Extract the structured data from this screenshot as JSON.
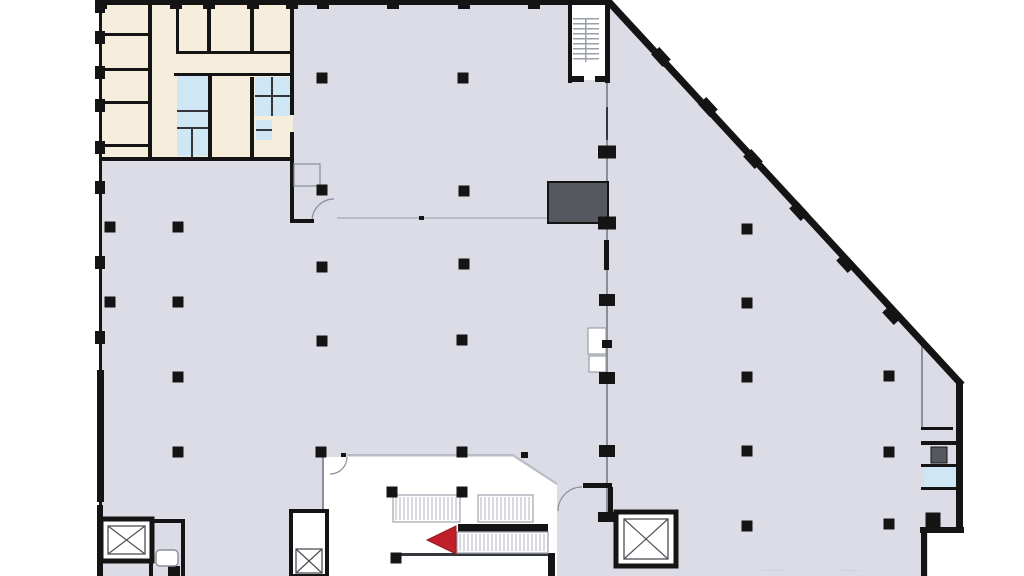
{
  "meta": {
    "type": "architectural-floor-plan",
    "description": "ground floor plan with office block, restrooms, stair, elevators, escalators and angled curtain wall",
    "visible_text_note": "no legible text; two tiny illegible dimension strings at bottom right"
  },
  "colors": {
    "page": "#ffffff",
    "floor": "#dcdce6",
    "room_beige": "#f6eddc",
    "room_blue": "#cfe7f5",
    "shaft_dark": "#55595f",
    "wall": "#141414",
    "wall_soft": "#33363a",
    "line_light": "#b9bcc6",
    "line_mid": "#8a8f98",
    "hatch": "#b5b8c2",
    "band_border": "#a7aab4",
    "tread": "#9aa0a8",
    "xline": "#4c5056",
    "arrow_red": "#c1202b",
    "text_gray": "#8f8f94",
    "void_white": "#ffffff"
  },
  "annotations": [
    {
      "name": "dimension-text-1",
      "x": 762,
      "y": 572,
      "text": "·········"
    },
    {
      "name": "dimension-text-2",
      "x": 837,
      "y": 572,
      "text": "·········"
    }
  ],
  "plan": {
    "canvas": {
      "w": 1024,
      "h": 576
    },
    "floor_points": "99,0 609,0 962,385 962,530 928,530 928,576 99,576",
    "void_points": "323,457 513,457 557,485 557,576 323,576",
    "fills": [
      {
        "n": "office-block",
        "x": 102,
        "y": 0,
        "w": 191,
        "h": 158,
        "f": "room_beige"
      },
      {
        "n": "restroom-left",
        "x": 177,
        "y": 76,
        "w": 31,
        "h": 80,
        "f": "room_blue"
      },
      {
        "n": "restroom-right",
        "x": 255,
        "y": 77,
        "w": 35,
        "h": 39,
        "f": "room_blue"
      },
      {
        "n": "sink-fixture",
        "x": 256,
        "y": 120,
        "w": 16,
        "h": 20,
        "f": "room_blue"
      },
      {
        "n": "right-room-blue",
        "x": 924,
        "y": 467,
        "w": 34,
        "h": 21,
        "f": "room_blue"
      },
      {
        "n": "stair-room",
        "x": 568,
        "y": 2,
        "w": 40,
        "h": 78,
        "f": "void_white"
      }
    ],
    "outlined": [
      {
        "n": "service-shaft",
        "x": 548,
        "y": 182,
        "w": 60,
        "h": 41,
        "f": "shaft_dark",
        "s": "wall",
        "sw": 2
      },
      {
        "n": "vestibule-closet",
        "x": 294,
        "y": 164,
        "w": 26,
        "h": 22,
        "f": "none",
        "s": "line_mid",
        "sw": 1.2
      },
      {
        "n": "spine-notch",
        "x": 588,
        "y": 328,
        "w": 18,
        "h": 26,
        "f": "void_white",
        "s": "line_mid",
        "sw": 1
      },
      {
        "n": "spine-notch",
        "x": 589,
        "y": 356,
        "w": 17,
        "h": 16,
        "f": "void_white",
        "s": "line_mid",
        "sw": 1
      },
      {
        "n": "wc-fixture",
        "x": 156,
        "y": 550,
        "w": 22,
        "h": 16,
        "f": "void_white",
        "s": "line_mid",
        "sw": 1.4,
        "rx": 4
      },
      {
        "n": "right-fixture",
        "x": 931,
        "y": 447,
        "w": 16,
        "h": 16,
        "f": "shaft_dark",
        "s": "wall",
        "sw": 1
      }
    ],
    "lines": [
      {
        "n": "glass-partition",
        "x": 337,
        "y": 217,
        "w": 211,
        "h": 2,
        "c": "line_light"
      },
      {
        "n": "void-top-line",
        "x": 347,
        "y": 454,
        "w": 166,
        "h": 2,
        "c": "line_light"
      },
      {
        "n": "void-left-line",
        "x": 322,
        "y": 457,
        "w": 2,
        "h": 119,
        "c": "line_mid"
      },
      {
        "n": "spine-line",
        "x": 606,
        "y": 83,
        "w": 2,
        "h": 430,
        "c": "line_mid"
      },
      {
        "n": "spine-dash",
        "x": 606,
        "y": 107,
        "w": 2,
        "h": 33,
        "c": "wall_soft"
      },
      {
        "n": "right-partition",
        "x": 921,
        "y": 345,
        "w": 2,
        "h": 84,
        "c": "line_mid"
      },
      {
        "n": "void-bottom-line",
        "x": 393,
        "y": 553,
        "w": 157,
        "h": 3,
        "c": "wall_soft"
      },
      {
        "n": "stall-line",
        "x": 177,
        "y": 110,
        "w": 31,
        "h": 2,
        "c": "wall_soft"
      },
      {
        "n": "stall-line",
        "x": 177,
        "y": 127,
        "w": 31,
        "h": 2,
        "c": "wall_soft"
      },
      {
        "n": "stall-line",
        "x": 191,
        "y": 127,
        "w": 2,
        "h": 30,
        "c": "wall_soft"
      },
      {
        "n": "stall-line",
        "x": 255,
        "y": 95,
        "w": 35,
        "h": 2,
        "c": "wall_soft"
      },
      {
        "n": "stall-line",
        "x": 271,
        "y": 77,
        "w": 2,
        "h": 39,
        "c": "wall_soft"
      },
      {
        "n": "stall-line",
        "x": 256,
        "y": 129,
        "w": 16,
        "h": 2,
        "c": "wall_soft"
      },
      {
        "n": "door-stop",
        "x": 341,
        "y": 453,
        "w": 5,
        "h": 4,
        "c": "wall"
      },
      {
        "n": "door-stop",
        "x": 419,
        "y": 216,
        "w": 5,
        "h": 4,
        "c": "wall"
      },
      {
        "n": "small-column",
        "x": 521,
        "y": 452,
        "w": 7,
        "h": 6,
        "c": "wall"
      }
    ],
    "paths": [
      {
        "n": "void-diagonal-line",
        "d": "M513,455 L557,484",
        "c": "line_light",
        "sw": 2
      },
      {
        "n": "door-arc",
        "d": "M347,457 A17,17 0 0 1 330,474",
        "c": "line_mid",
        "sw": 1.2
      },
      {
        "n": "door-arc",
        "d": "M312,221 A22,22 0 0 1 334,199",
        "c": "line_mid",
        "sw": 1.2
      },
      {
        "n": "door-arc",
        "d": "M582,487 A24,24 0 0 0 558,511",
        "c": "line_mid",
        "sw": 1.2
      },
      {
        "n": "door-leaf",
        "d": "M297,519 L321,541",
        "c": "line_mid",
        "sw": 1.2
      },
      {
        "n": "diagonal-curtain-wall",
        "d": "M609,2 L962,385",
        "c": "wall",
        "sw": 7
      }
    ],
    "walls": [
      {
        "x": 95,
        "y": 0,
        "w": 516,
        "h": 5
      },
      {
        "x": 99,
        "y": 0,
        "w": 3,
        "h": 576
      },
      {
        "x": 97,
        "y": 370,
        "w": 7,
        "h": 132
      },
      {
        "x": 97,
        "y": 505,
        "w": 6,
        "h": 71
      },
      {
        "x": 148,
        "y": 0,
        "w": 4,
        "h": 158
      },
      {
        "x": 176,
        "y": 0,
        "w": 3,
        "h": 53
      },
      {
        "x": 207,
        "y": 0,
        "w": 4,
        "h": 53
      },
      {
        "x": 208,
        "y": 75,
        "w": 4,
        "h": 83
      },
      {
        "x": 250,
        "y": 0,
        "w": 4,
        "h": 53
      },
      {
        "x": 250,
        "y": 77,
        "w": 4,
        "h": 80
      },
      {
        "x": 103,
        "y": 33,
        "w": 46,
        "h": 3
      },
      {
        "x": 103,
        "y": 68,
        "w": 46,
        "h": 3
      },
      {
        "x": 103,
        "y": 101,
        "w": 46,
        "h": 3
      },
      {
        "x": 103,
        "y": 144,
        "w": 46,
        "h": 3
      },
      {
        "x": 176,
        "y": 51,
        "w": 117,
        "h": 3
      },
      {
        "x": 174,
        "y": 73,
        "w": 119,
        "h": 3
      },
      {
        "x": 101,
        "y": 157,
        "w": 193,
        "h": 4
      },
      {
        "x": 290,
        "y": 0,
        "w": 4,
        "h": 115
      },
      {
        "x": 290,
        "y": 132,
        "w": 4,
        "h": 31
      },
      {
        "x": 290,
        "y": 153,
        "w": 4,
        "h": 70
      },
      {
        "x": 290,
        "y": 219,
        "w": 24,
        "h": 4
      },
      {
        "x": 568,
        "y": 0,
        "w": 4,
        "h": 83
      },
      {
        "x": 605,
        "y": 0,
        "w": 5,
        "h": 83
      },
      {
        "x": 568,
        "y": 76,
        "w": 16,
        "h": 6
      },
      {
        "x": 595,
        "y": 76,
        "w": 15,
        "h": 6
      },
      {
        "x": 604,
        "y": 240,
        "w": 5,
        "h": 30
      },
      {
        "x": 583,
        "y": 483,
        "w": 29,
        "h": 5
      },
      {
        "x": 608,
        "y": 487,
        "w": 5,
        "h": 33
      },
      {
        "x": 616,
        "y": 556,
        "w": 60,
        "h": 9
      },
      {
        "x": 548,
        "y": 553,
        "w": 7,
        "h": 23
      },
      {
        "x": 458,
        "y": 524,
        "w": 90,
        "h": 8
      },
      {
        "x": 921,
        "y": 427,
        "w": 32,
        "h": 3
      },
      {
        "x": 921,
        "y": 441,
        "w": 42,
        "h": 4
      },
      {
        "x": 921,
        "y": 464,
        "w": 42,
        "h": 3
      },
      {
        "x": 921,
        "y": 487,
        "w": 42,
        "h": 3
      },
      {
        "x": 956,
        "y": 383,
        "w": 7,
        "h": 147
      },
      {
        "x": 920,
        "y": 527,
        "w": 44,
        "h": 6
      },
      {
        "x": 921,
        "y": 530,
        "w": 6,
        "h": 46
      },
      {
        "x": 149,
        "y": 519,
        "w": 4,
        "h": 57
      },
      {
        "x": 149,
        "y": 519,
        "w": 36,
        "h": 4
      },
      {
        "x": 181,
        "y": 519,
        "w": 4,
        "h": 57
      },
      {
        "x": 168,
        "y": 566,
        "w": 12,
        "h": 10
      },
      {
        "x": 291,
        "y": 545,
        "w": 36,
        "h": 4
      }
    ],
    "top_piers_x": [
      95,
      170,
      203,
      247,
      286,
      317,
      387,
      458,
      528
    ],
    "left_piers_y": [
      0,
      31,
      66,
      99,
      141,
      181,
      256,
      331
    ],
    "bands": [
      {
        "n": "escalator-band",
        "x": 393,
        "y": 495,
        "w": 67,
        "h": 27
      },
      {
        "n": "escalator-band",
        "x": 478,
        "y": 495,
        "w": 55,
        "h": 27
      },
      {
        "n": "escalator-band",
        "x": 457,
        "y": 532,
        "w": 91,
        "h": 21
      }
    ],
    "stair": {
      "x": 573,
      "y": 18,
      "w": 26,
      "count": 9,
      "step": 5,
      "rail_x": 585,
      "rail_h": 44
    },
    "shaft_frames": [
      {
        "n": "elevator-shaft",
        "x": 101,
        "y": 519,
        "w": 51,
        "h": 42,
        "sw": 5
      },
      {
        "n": "elevator-shaft",
        "x": 291,
        "y": 511,
        "w": 36,
        "h": 65,
        "sw": 4
      },
      {
        "n": "elevator-shaft",
        "x": 616,
        "y": 512,
        "w": 60,
        "h": 54,
        "sw": 5
      }
    ],
    "xboxes": [
      {
        "x": 108,
        "y": 526,
        "w": 37,
        "h": 28
      },
      {
        "x": 296,
        "y": 549,
        "w": 26,
        "h": 24
      },
      {
        "x": 624,
        "y": 519,
        "w": 44,
        "h": 40
      }
    ],
    "columns": [
      [
        322,
        78
      ],
      [
        463,
        78
      ],
      [
        464,
        191
      ],
      [
        464,
        264
      ],
      [
        462,
        340
      ],
      [
        322,
        190
      ],
      [
        322,
        267
      ],
      [
        322,
        341
      ],
      [
        110,
        227
      ],
      [
        178,
        227
      ],
      [
        110,
        302
      ],
      [
        178,
        302
      ],
      [
        178,
        377
      ],
      [
        178,
        452
      ],
      [
        321,
        452
      ],
      [
        462,
        452
      ],
      [
        392,
        492
      ],
      [
        462,
        492
      ],
      [
        396,
        558
      ],
      [
        607,
        152,
        18,
        13
      ],
      [
        607,
        223,
        18,
        13
      ],
      [
        607,
        300,
        16,
        12
      ],
      [
        607,
        344,
        10,
        8
      ],
      [
        607,
        378,
        16,
        12
      ],
      [
        607,
        451,
        16,
        12
      ],
      [
        607,
        517,
        18,
        10
      ],
      [
        747,
        229
      ],
      [
        747,
        303
      ],
      [
        747,
        377
      ],
      [
        747,
        451
      ],
      [
        747,
        526
      ],
      [
        889,
        376
      ],
      [
        889,
        452
      ],
      [
        889,
        524
      ],
      [
        933,
        520,
        15,
        15
      ]
    ],
    "diag_columns": {
      "angle": 47.5,
      "w": 17,
      "h": 11,
      "pts": [
        [
          661,
          57
        ],
        [
          708,
          107
        ],
        [
          753,
          159
        ],
        [
          799,
          211
        ],
        [
          846,
          263
        ],
        [
          892,
          315
        ]
      ]
    },
    "arrow": {
      "points": "456,526 427,540 456,554"
    }
  }
}
